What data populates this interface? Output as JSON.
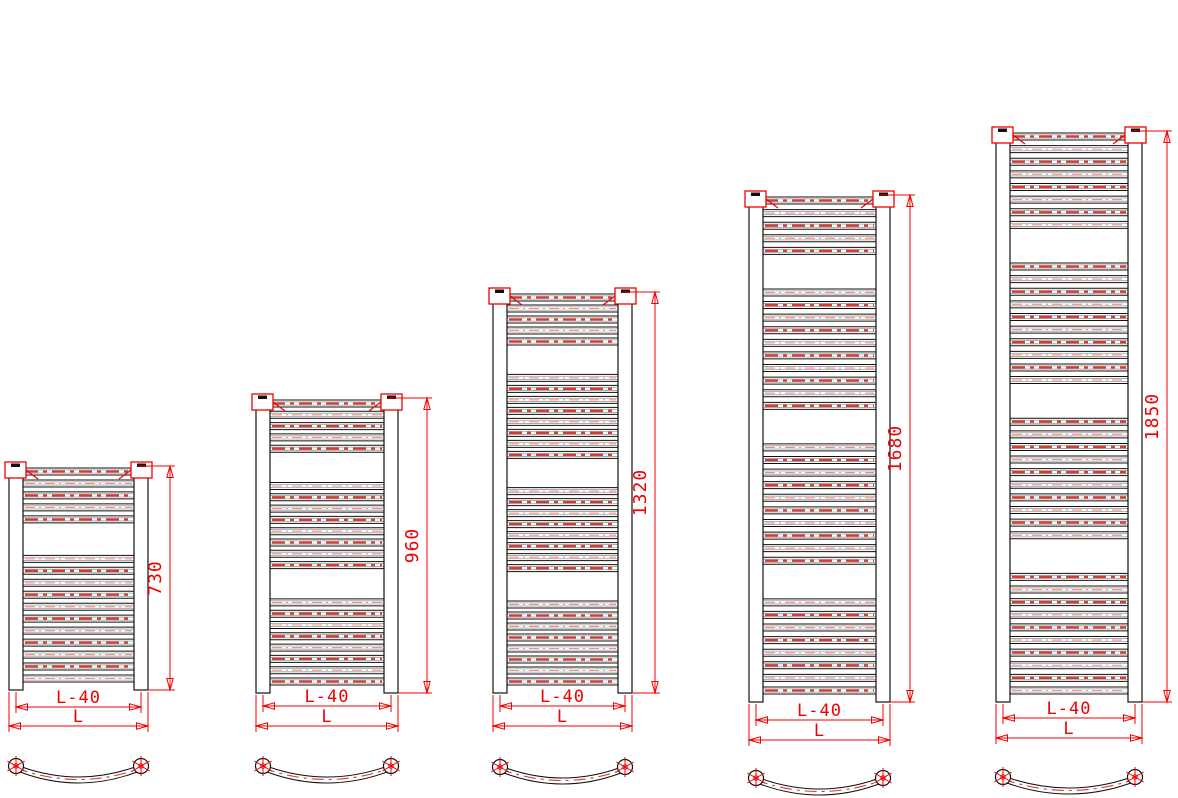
{
  "drawing": {
    "type": "technical-drawing",
    "subject": "Curved heated towel-rail radiators, five height variants: front elevation with dimensions and curved-tube top view",
    "colors": {
      "background": "#ffffff",
      "outline": "#111111",
      "inner_edge": "#9b9b9b",
      "dimension": "#f20000",
      "centerline_bold": "#d63a31",
      "centerline_light": "#ef8f86"
    },
    "width_labels": {
      "inner": "L-40",
      "outer": "L"
    },
    "radiators": [
      {
        "height_label": "730",
        "groups": [
          5,
          11
        ],
        "x": 9,
        "width": 139,
        "top": 462,
        "bottom": 690,
        "dim_x": 170,
        "dim_y_inner": 707,
        "dim_y_outer": 726,
        "arc_y": 766
      },
      {
        "height_label": "960",
        "groups": [
          5,
          8,
          8
        ],
        "x": 256,
        "width": 142,
        "top": 394,
        "bottom": 693,
        "dim_x": 427,
        "dim_y_inner": 706,
        "dim_y_outer": 726,
        "arc_y": 766
      },
      {
        "height_label": "1320",
        "groups": [
          5,
          8,
          8,
          8
        ],
        "x": 493,
        "width": 139,
        "top": 288,
        "bottom": 693,
        "dim_x": 655,
        "dim_y_inner": 706,
        "dim_y_outer": 726,
        "arc_y": 767
      },
      {
        "height_label": "1680",
        "groups": [
          5,
          10,
          10,
          8
        ],
        "x": 749,
        "width": 141,
        "top": 191,
        "bottom": 702,
        "dim_x": 910,
        "dim_y_inner": 720,
        "dim_y_outer": 740,
        "arc_y": 778
      },
      {
        "height_label": "1850",
        "groups": [
          8,
          10,
          10,
          10
        ],
        "x": 996,
        "width": 146,
        "top": 127,
        "bottom": 702,
        "dim_x": 1167,
        "dim_y_inner": 718,
        "dim_y_outer": 738,
        "arc_y": 777
      }
    ]
  }
}
